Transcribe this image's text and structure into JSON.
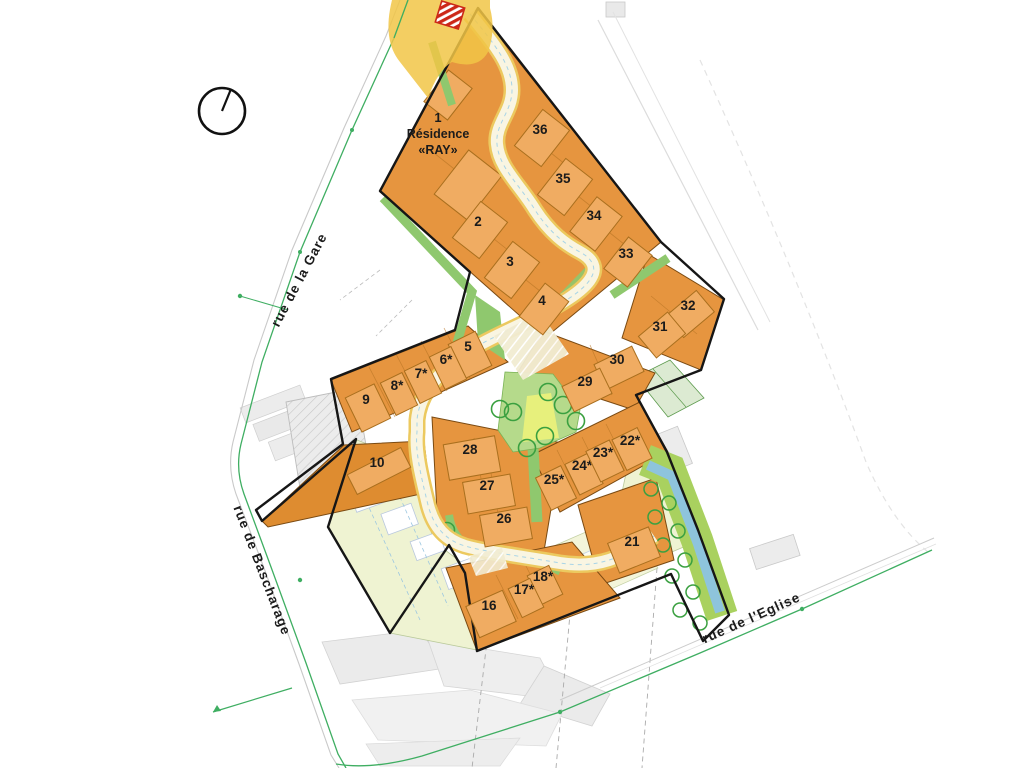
{
  "map_title": "Residential subdivision site plan",
  "compass": {
    "icon": "north-indicator"
  },
  "streets": [
    {
      "id": "gare",
      "label": "rue de la Gare"
    },
    {
      "id": "bascharage",
      "label": "rue de Bascharage"
    },
    {
      "id": "eglise",
      "label": "rue de l'Eglise"
    }
  ],
  "residence": {
    "number": "1",
    "name_line1": "Résidence",
    "name_line2": "«RAY»"
  },
  "lots": [
    {
      "label": "2",
      "x": 478,
      "y": 222,
      "a": -52,
      "w": 46,
      "h": 34
    },
    {
      "label": "3",
      "x": 510,
      "y": 262,
      "a": -52,
      "w": 46,
      "h": 34
    },
    {
      "label": "4",
      "x": 542,
      "y": 301,
      "a": -52,
      "w": 42,
      "h": 30
    },
    {
      "label": "36",
      "x": 540,
      "y": 130,
      "a": -52,
      "w": 46,
      "h": 34
    },
    {
      "label": "35",
      "x": 563,
      "y": 179,
      "a": -52,
      "w": 46,
      "h": 34
    },
    {
      "label": "34",
      "x": 594,
      "y": 216,
      "a": -52,
      "w": 44,
      "h": 32
    },
    {
      "label": "33",
      "x": 626,
      "y": 254,
      "a": -52,
      "w": 40,
      "h": 30
    },
    {
      "label": "32",
      "x": 688,
      "y": 306,
      "a": -40,
      "w": 40,
      "h": 28
    },
    {
      "label": "31",
      "x": 660,
      "y": 327,
      "a": -40,
      "w": 38,
      "h": 28
    },
    {
      "label": "30",
      "x": 617,
      "y": 360,
      "a": -26,
      "w": 42,
      "h": 28
    },
    {
      "label": "29",
      "x": 585,
      "y": 382,
      "a": -26,
      "w": 42,
      "h": 28
    },
    {
      "label": "5",
      "x": 468,
      "y": 347,
      "a": -26,
      "w": 30,
      "h": 38
    },
    {
      "label": "6*",
      "x": 446,
      "y": 360,
      "a": -26,
      "w": 24,
      "h": 36
    },
    {
      "label": "7*",
      "x": 421,
      "y": 374,
      "a": -26,
      "w": 24,
      "h": 36
    },
    {
      "label": "8*",
      "x": 397,
      "y": 386,
      "a": -26,
      "w": 24,
      "h": 36
    },
    {
      "label": "9",
      "x": 366,
      "y": 400,
      "a": -26,
      "w": 32,
      "h": 38
    },
    {
      "label": "10",
      "x": 377,
      "y": 463,
      "a": -27,
      "w": 60,
      "h": 22
    },
    {
      "label": "28",
      "x": 470,
      "y": 450,
      "a": -10,
      "w": 52,
      "h": 36
    },
    {
      "label": "27",
      "x": 487,
      "y": 486,
      "a": -10,
      "w": 48,
      "h": 32
    },
    {
      "label": "26",
      "x": 504,
      "y": 519,
      "a": -10,
      "w": 48,
      "h": 32
    },
    {
      "label": "25*",
      "x": 554,
      "y": 480,
      "a": -26,
      "w": 28,
      "h": 36
    },
    {
      "label": "24*",
      "x": 582,
      "y": 466,
      "a": -26,
      "w": 26,
      "h": 34
    },
    {
      "label": "23*",
      "x": 603,
      "y": 453,
      "a": -26,
      "w": 26,
      "h": 34
    },
    {
      "label": "22*",
      "x": 630,
      "y": 441,
      "a": -26,
      "w": 28,
      "h": 34
    },
    {
      "label": "21",
      "x": 632,
      "y": 542,
      "a": -22,
      "w": 44,
      "h": 32
    },
    {
      "label": "18*",
      "x": 543,
      "y": 577,
      "a": -26,
      "w": 24,
      "h": 32
    },
    {
      "label": "17*",
      "x": 524,
      "y": 590,
      "a": -26,
      "w": 24,
      "h": 32
    },
    {
      "label": "16",
      "x": 489,
      "y": 606,
      "a": -24,
      "w": 40,
      "h": 34
    }
  ],
  "colors": {
    "lot_orange": "#e6953f",
    "lot_orange_dark": "#de8c30",
    "building_orange": "#f0ac62",
    "road_cream": "#f9f5e2",
    "road_edge_yellow": "#ecc95f",
    "green_strip": "#8fc86e",
    "park_green": "#b5da8b",
    "park_yellow": "#e7f07c",
    "water_blue": "#8ec4dc",
    "pale_zone": "#eff3d2",
    "light_green_parcel": "#dcead2",
    "street_line_green": "#3fae62",
    "boundary_black": "#161616",
    "junction_yellow": "#f1c647",
    "marker_red": "#cc2818"
  }
}
